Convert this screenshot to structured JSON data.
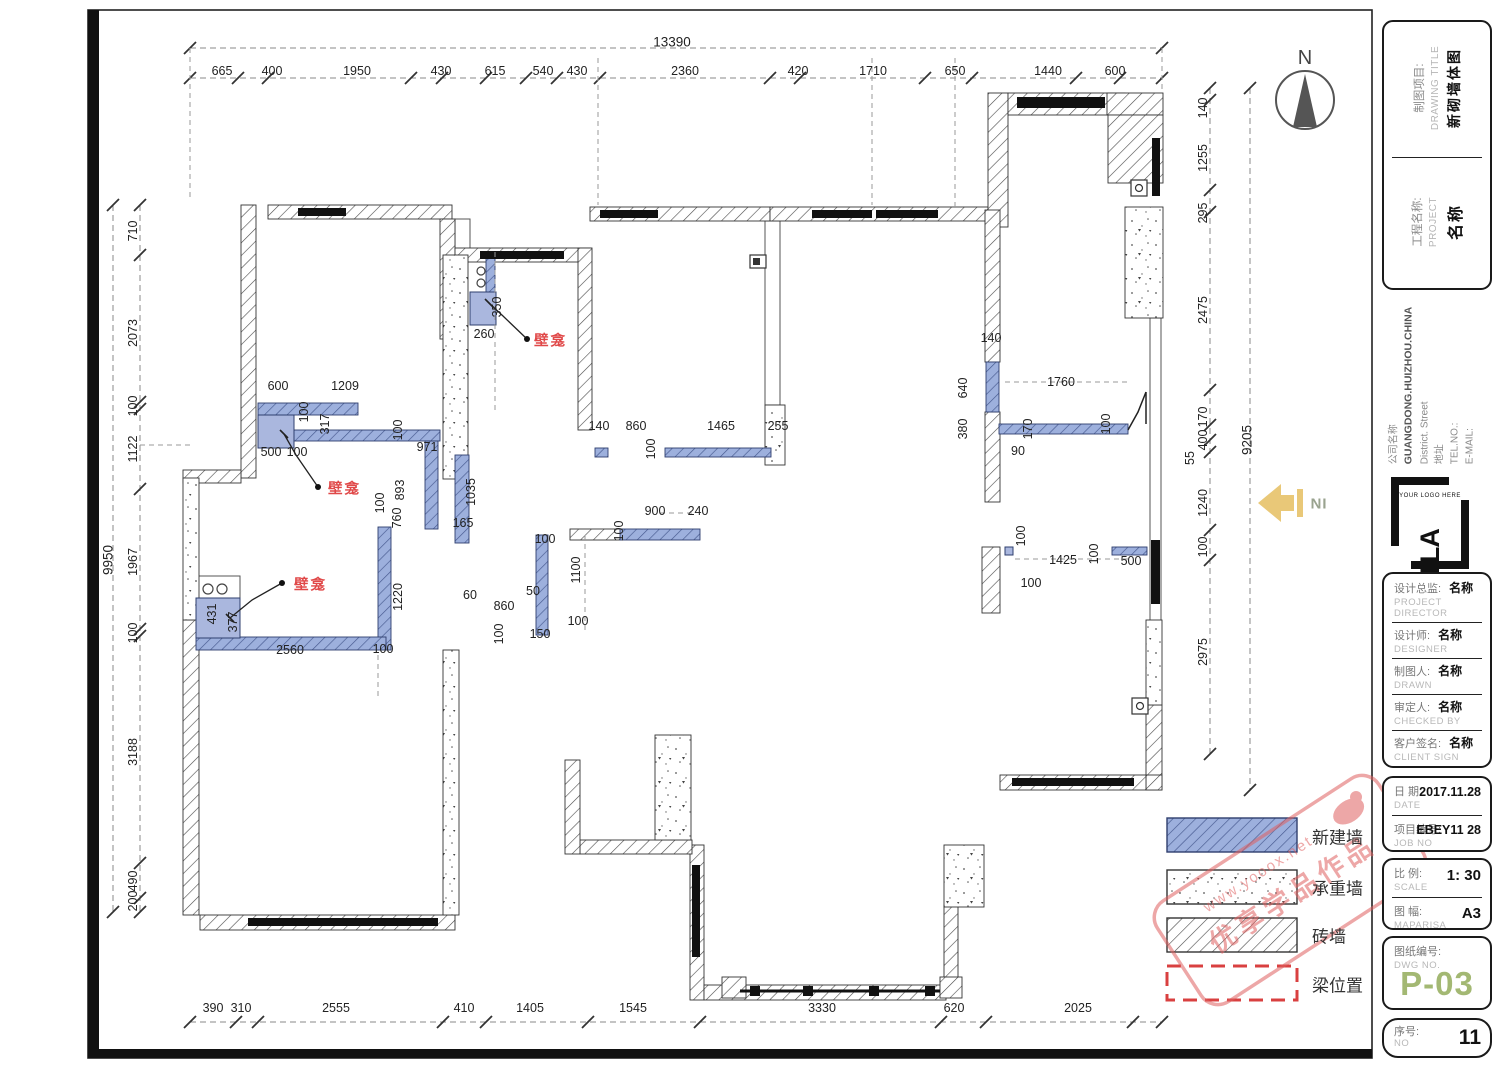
{
  "colors": {
    "accent_green": "#a3b873",
    "annotation_red": "#e04848",
    "new_wall_blue": "#9db0dd",
    "beam_red": "#d94040",
    "watermark_red": "#e06060",
    "entrance_yellow": "#e9c878"
  },
  "north": {
    "label": "N"
  },
  "entrance": {
    "label": "IN"
  },
  "watermark": {
    "line1": "优享学品作品",
    "line2": "www.yooox.net"
  },
  "legend": {
    "items": [
      {
        "label": "新建墙",
        "type": "new-wall"
      },
      {
        "label": "承重墙",
        "type": "load-bearing-wall"
      },
      {
        "label": "砖墙",
        "type": "brick-wall"
      },
      {
        "label": "梁位置",
        "type": "beam-position"
      }
    ]
  },
  "title_block": {
    "drawing_title": {
      "zh": "制图项目:",
      "en": "DRAWING TITLE",
      "value": "新砌墙体图"
    },
    "project": {
      "zh": "工程名称:",
      "en": "PROJECT",
      "value": "名称"
    },
    "company": {
      "name_label": "公司名称",
      "name": "GUANGDONG.HUIZHOU.CHINA",
      "address_line": "District.      Street",
      "address_label": "地址",
      "tel_label": "TEL.NO.:",
      "email_label": "E-MAIL:"
    },
    "logo": {
      "text": "TLA",
      "sub": "YOUR LOGO HERE"
    },
    "people": [
      {
        "zh": "设计总监:",
        "en": "PROJECT DIRECTOR",
        "value": "名称"
      },
      {
        "zh": "设计师:",
        "en": "DESIGNER",
        "value": "名称"
      },
      {
        "zh": "制图人:",
        "en": "DRAWN",
        "value": "名称"
      },
      {
        "zh": "审定人:",
        "en": "CHECKED BY",
        "value": "名称"
      },
      {
        "zh": "客户签名:",
        "en": "CLIENT SIGN",
        "value": "名称"
      }
    ],
    "date": {
      "zh": "日 期:",
      "en": "DATE",
      "value": "2017.11.28"
    },
    "job": {
      "zh": "项目编号:",
      "en": "JOB NO",
      "value": "EBEY11 28"
    },
    "scale": {
      "zh": "比 例:",
      "en": "SCALE",
      "value": "1:  30"
    },
    "size": {
      "zh": "图 幅:",
      "en": "MAPARISA",
      "value": "A3"
    },
    "dwg": {
      "zh": "图纸编号:",
      "en": "DWG NO.",
      "value": "P-03"
    },
    "no": {
      "zh": "序号:",
      "en": "NO",
      "value": "11"
    }
  },
  "annotations": {
    "items": [
      {
        "t": "壁龛",
        "x": 534,
        "y": 340
      },
      {
        "t": "壁龛",
        "x": 328,
        "y": 488
      },
      {
        "t": "壁龛",
        "x": 294,
        "y": 584
      }
    ]
  },
  "dimensions": {
    "labels": [
      {
        "t": "13390",
        "x": 672,
        "y": 42,
        "big": 1
      },
      {
        "t": "665",
        "x": 222,
        "y": 71
      },
      {
        "t": "400",
        "x": 272,
        "y": 71
      },
      {
        "t": "1950",
        "x": 357,
        "y": 71
      },
      {
        "t": "430",
        "x": 441,
        "y": 71
      },
      {
        "t": "615",
        "x": 495,
        "y": 71
      },
      {
        "t": "540",
        "x": 543,
        "y": 71
      },
      {
        "t": "430",
        "x": 577,
        "y": 71
      },
      {
        "t": "2360",
        "x": 685,
        "y": 71
      },
      {
        "t": "420",
        "x": 798,
        "y": 71
      },
      {
        "t": "1710",
        "x": 873,
        "y": 71
      },
      {
        "t": "650",
        "x": 955,
        "y": 71
      },
      {
        "t": "1440",
        "x": 1048,
        "y": 71
      },
      {
        "t": "600",
        "x": 1115,
        "y": 71
      },
      {
        "t": "9950",
        "x": 108,
        "y": 560,
        "r": 1,
        "big": 1
      },
      {
        "t": "710",
        "x": 133,
        "y": 231,
        "r": 1
      },
      {
        "t": "2073",
        "x": 133,
        "y": 333,
        "r": 1
      },
      {
        "t": "100",
        "x": 133,
        "y": 406,
        "r": 1
      },
      {
        "t": "1122",
        "x": 133,
        "y": 449,
        "r": 1
      },
      {
        "t": "1967",
        "x": 133,
        "y": 562,
        "r": 1
      },
      {
        "t": "100",
        "x": 133,
        "y": 633,
        "r": 1
      },
      {
        "t": "3188",
        "x": 133,
        "y": 752,
        "r": 1
      },
      {
        "t": "490",
        "x": 133,
        "y": 881,
        "r": 1
      },
      {
        "t": "200",
        "x": 133,
        "y": 901,
        "r": 1
      },
      {
        "t": "9205",
        "x": 1247,
        "y": 440,
        "r": 1,
        "big": 1
      },
      {
        "t": "140",
        "x": 1203,
        "y": 108,
        "r": 1
      },
      {
        "t": "1255",
        "x": 1203,
        "y": 158,
        "r": 1
      },
      {
        "t": "295",
        "x": 1203,
        "y": 213,
        "r": 1
      },
      {
        "t": "2475",
        "x": 1203,
        "y": 310,
        "r": 1
      },
      {
        "t": "170",
        "x": 1203,
        "y": 417,
        "r": 1
      },
      {
        "t": "400",
        "x": 1203,
        "y": 440,
        "r": 1
      },
      {
        "t": "55",
        "x": 1190,
        "y": 458,
        "r": 1
      },
      {
        "t": "1240",
        "x": 1203,
        "y": 503,
        "r": 1
      },
      {
        "t": "100",
        "x": 1203,
        "y": 547,
        "r": 1
      },
      {
        "t": "2975",
        "x": 1203,
        "y": 652,
        "r": 1
      },
      {
        "t": "390",
        "x": 213,
        "y": 1008
      },
      {
        "t": "310",
        "x": 241,
        "y": 1008
      },
      {
        "t": "2555",
        "x": 336,
        "y": 1008
      },
      {
        "t": "410",
        "x": 464,
        "y": 1008
      },
      {
        "t": "1405",
        "x": 530,
        "y": 1008
      },
      {
        "t": "1545",
        "x": 633,
        "y": 1008
      },
      {
        "t": "3330",
        "x": 822,
        "y": 1008
      },
      {
        "t": "620",
        "x": 954,
        "y": 1008
      },
      {
        "t": "2025",
        "x": 1078,
        "y": 1008
      },
      {
        "t": "600",
        "x": 278,
        "y": 386
      },
      {
        "t": "1209",
        "x": 345,
        "y": 386
      },
      {
        "t": "100",
        "x": 304,
        "y": 412,
        "r": 1
      },
      {
        "t": "317",
        "x": 325,
        "y": 424,
        "r": 1
      },
      {
        "t": "100",
        "x": 398,
        "y": 430,
        "r": 1
      },
      {
        "t": "971",
        "x": 427,
        "y": 447
      },
      {
        "t": "500",
        "x": 271,
        "y": 452
      },
      {
        "t": "100",
        "x": 297,
        "y": 452
      },
      {
        "t": "893",
        "x": 400,
        "y": 490,
        "r": 1
      },
      {
        "t": "760",
        "x": 397,
        "y": 518,
        "r": 1
      },
      {
        "t": "100",
        "x": 380,
        "y": 503,
        "r": 1
      },
      {
        "t": "1035",
        "x": 471,
        "y": 492,
        "r": 1
      },
      {
        "t": "165",
        "x": 463,
        "y": 523
      },
      {
        "t": "350",
        "x": 497,
        "y": 307,
        "r": 1
      },
      {
        "t": "260",
        "x": 484,
        "y": 334
      },
      {
        "t": "431",
        "x": 212,
        "y": 614,
        "r": 1
      },
      {
        "t": "377",
        "x": 233,
        "y": 622,
        "r": 1
      },
      {
        "t": "2560",
        "x": 290,
        "y": 650
      },
      {
        "t": "100",
        "x": 383,
        "y": 649
      },
      {
        "t": "1220",
        "x": 398,
        "y": 597,
        "r": 1
      },
      {
        "t": "100",
        "x": 545,
        "y": 539
      },
      {
        "t": "900",
        "x": 655,
        "y": 511
      },
      {
        "t": "240",
        "x": 698,
        "y": 511
      },
      {
        "t": "100",
        "x": 619,
        "y": 531,
        "r": 1
      },
      {
        "t": "1100",
        "x": 576,
        "y": 570,
        "r": 1
      },
      {
        "t": "60",
        "x": 470,
        "y": 595
      },
      {
        "t": "860",
        "x": 504,
        "y": 606
      },
      {
        "t": "50",
        "x": 533,
        "y": 591
      },
      {
        "t": "100",
        "x": 499,
        "y": 634,
        "r": 1
      },
      {
        "t": "150",
        "x": 540,
        "y": 634
      },
      {
        "t": "100",
        "x": 578,
        "y": 621
      },
      {
        "t": "140",
        "x": 599,
        "y": 426
      },
      {
        "t": "860",
        "x": 636,
        "y": 426
      },
      {
        "t": "1465",
        "x": 721,
        "y": 426
      },
      {
        "t": "255",
        "x": 778,
        "y": 426
      },
      {
        "t": "100",
        "x": 651,
        "y": 449,
        "r": 1
      },
      {
        "t": "140",
        "x": 991,
        "y": 338
      },
      {
        "t": "640",
        "x": 963,
        "y": 388,
        "r": 1
      },
      {
        "t": "380",
        "x": 963,
        "y": 429,
        "r": 1
      },
      {
        "t": "1760",
        "x": 1061,
        "y": 382
      },
      {
        "t": "170",
        "x": 1028,
        "y": 429,
        "r": 1
      },
      {
        "t": "90",
        "x": 1018,
        "y": 451
      },
      {
        "t": "100",
        "x": 1106,
        "y": 424,
        "r": 1
      },
      {
        "t": "100",
        "x": 1021,
        "y": 536,
        "r": 1
      },
      {
        "t": "1425",
        "x": 1063,
        "y": 560
      },
      {
        "t": "100",
        "x": 1094,
        "y": 554,
        "r": 1
      },
      {
        "t": "500",
        "x": 1131,
        "y": 561
      },
      {
        "t": "100",
        "x": 1031,
        "y": 583
      }
    ]
  }
}
